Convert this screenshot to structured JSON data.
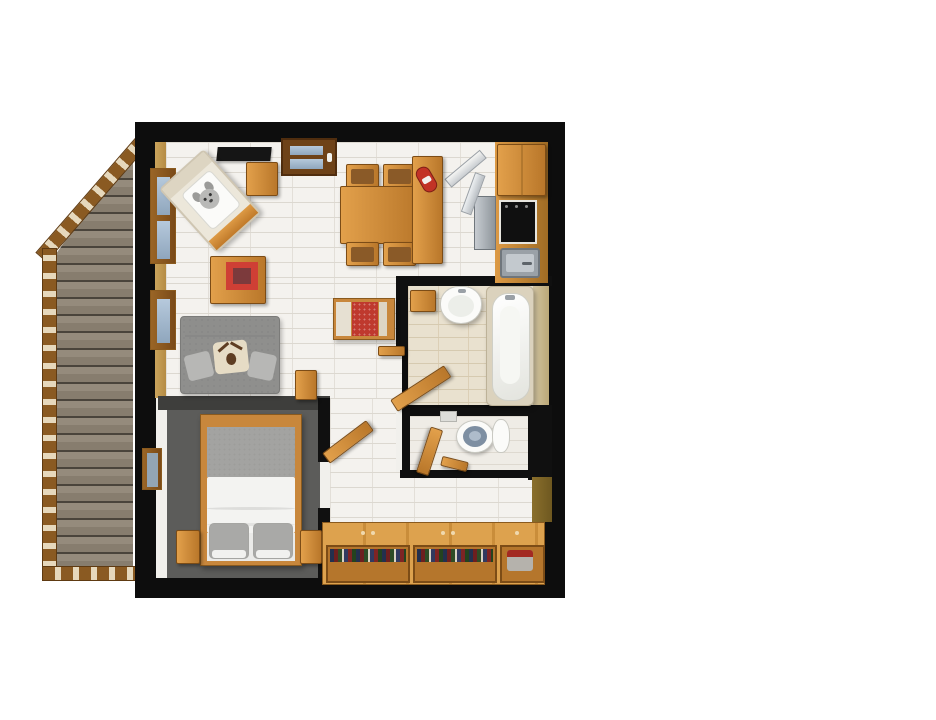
{
  "scene": {
    "title": "3D rendered top-down floor plan of a one-bedroom apartment with balcony",
    "style": "photorealistic architectural render, no visible text"
  },
  "rooms": {
    "balcony": {
      "name": "Balcony",
      "items": [
        "weathered wood deck",
        "slatted brown railing with diagonal corner"
      ]
    },
    "living_room": {
      "name": "Living room",
      "items": [
        "flat TV on top wall",
        "entry door with blue glass",
        "armchair with dog-print cushion",
        "small side table",
        "coffee table with red rug inset",
        "grey two-seat sofa with moose pillow",
        "lounge chair with red cushion",
        "dining table with four chairs"
      ]
    },
    "kitchen": {
      "name": "Kitchen",
      "items": [
        "upper cabinet",
        "black cooktop",
        "steel sink",
        "refrigerator with doors open",
        "counter island",
        "red kettle"
      ]
    },
    "bathroom": {
      "name": "Bathroom",
      "items": [
        "pedestal sink",
        "bathtub",
        "wooden wall shelf",
        "open wooden door"
      ]
    },
    "wc": {
      "name": "Toilet room",
      "items": [
        "toilet",
        "open wooden door",
        "small wooden bench",
        "tissue box"
      ]
    },
    "bedroom": {
      "name": "Bedroom",
      "items": [
        "double bed with white duvet and grey blanket",
        "two grey pillows",
        "two wooden nightstands",
        "window",
        "open wooden door"
      ]
    },
    "hallway": {
      "name": "Hallway",
      "items": [
        "long wooden sideboard",
        "two shelves of books",
        "storage cube with red item"
      ]
    }
  },
  "colors": {
    "wall_black": "#0d0d0d",
    "wood": "#d2913f",
    "wood_dark": "#8a5a1e",
    "deck_plank": "#8d8274",
    "railing": "#8a5a22",
    "window_glass": "#a3bad0",
    "living_tile": "#f4f2ee",
    "bath_tile": "#e9e1cf",
    "bedroom_floor": "#5c5c5a",
    "sofa_grey": "#8f8f8d",
    "accent_red": "#bf392e",
    "duvet_white": "#f3f3f1",
    "tan_wall": "#c49a52",
    "page_background": "#ffffff"
  }
}
